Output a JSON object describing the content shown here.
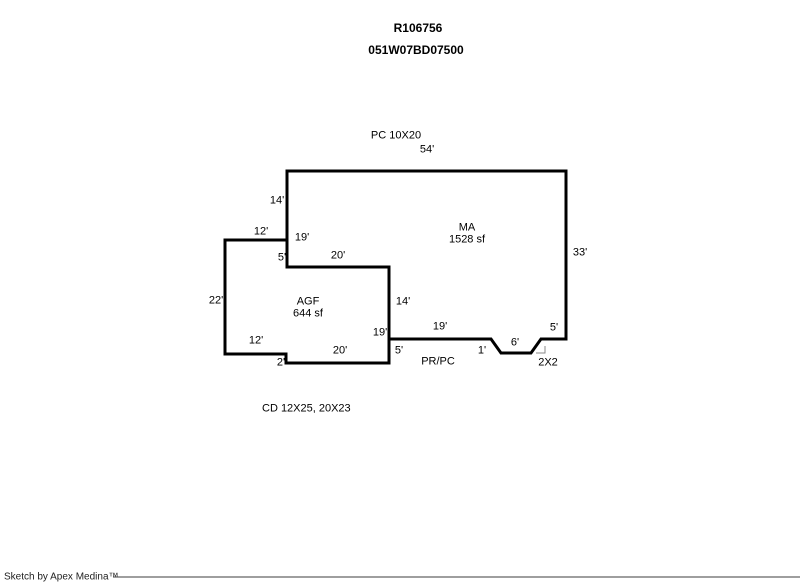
{
  "header": {
    "record_id": "R106756",
    "parcel_id": "051W07BD07500"
  },
  "sketch": {
    "labels": {
      "pc_note": "PC 10X20",
      "dim_top_54": "54'",
      "dim_left_14": "14'",
      "dim_left_12": "12'",
      "dim_left_19": "19'",
      "dim_left_5": "5'",
      "dim_mid_20": "20'",
      "area_ma_code": "MA",
      "area_ma_sf": "1528 sf",
      "dim_right_33": "33'",
      "dim_far_left_22": "22'",
      "area_agf_code": "AGF",
      "area_agf_sf": "644 sf",
      "dim_agf_right_14": "14'",
      "dim_agf_19": "19'",
      "dim_bottom_19": "19'",
      "dim_porch_5": "5'",
      "dim_bottom_12": "12'",
      "dim_bottom_20": "20'",
      "dim_bottom_2": "2'",
      "dim_notch_1": "1'",
      "dim_notch_6": "6'",
      "dim_notch_5": "5'",
      "notch_cut": "2X2",
      "porch_code": "PR/PC",
      "cd_note": "CD 12X25, 20X23"
    },
    "areas": [
      {
        "code": "MA",
        "size_sf": 1528
      },
      {
        "code": "AGF",
        "size_sf": 644
      }
    ],
    "geometry": {
      "ma_outline": "287,267 287,171 566,171 566,339 541,339 531,353 501,353 491,339 389,339",
      "shared_wall": "287,267 389,267",
      "agf_right_wall": "389,267 389,363",
      "agf_outline": "287,240 225,240 225,354 286,354 286,363 389,363",
      "corner_mark": "536,353 545,353 545,346",
      "footer_rule": "113,577 800,577"
    }
  },
  "footer": {
    "credit": "Sketch by Apex Medina™"
  },
  "colors": {
    "wall": "#000000",
    "text": "#000000",
    "corner_mark": "#8a8a8a",
    "footer_rule": "#3d3d3d",
    "background": "#ffffff"
  }
}
